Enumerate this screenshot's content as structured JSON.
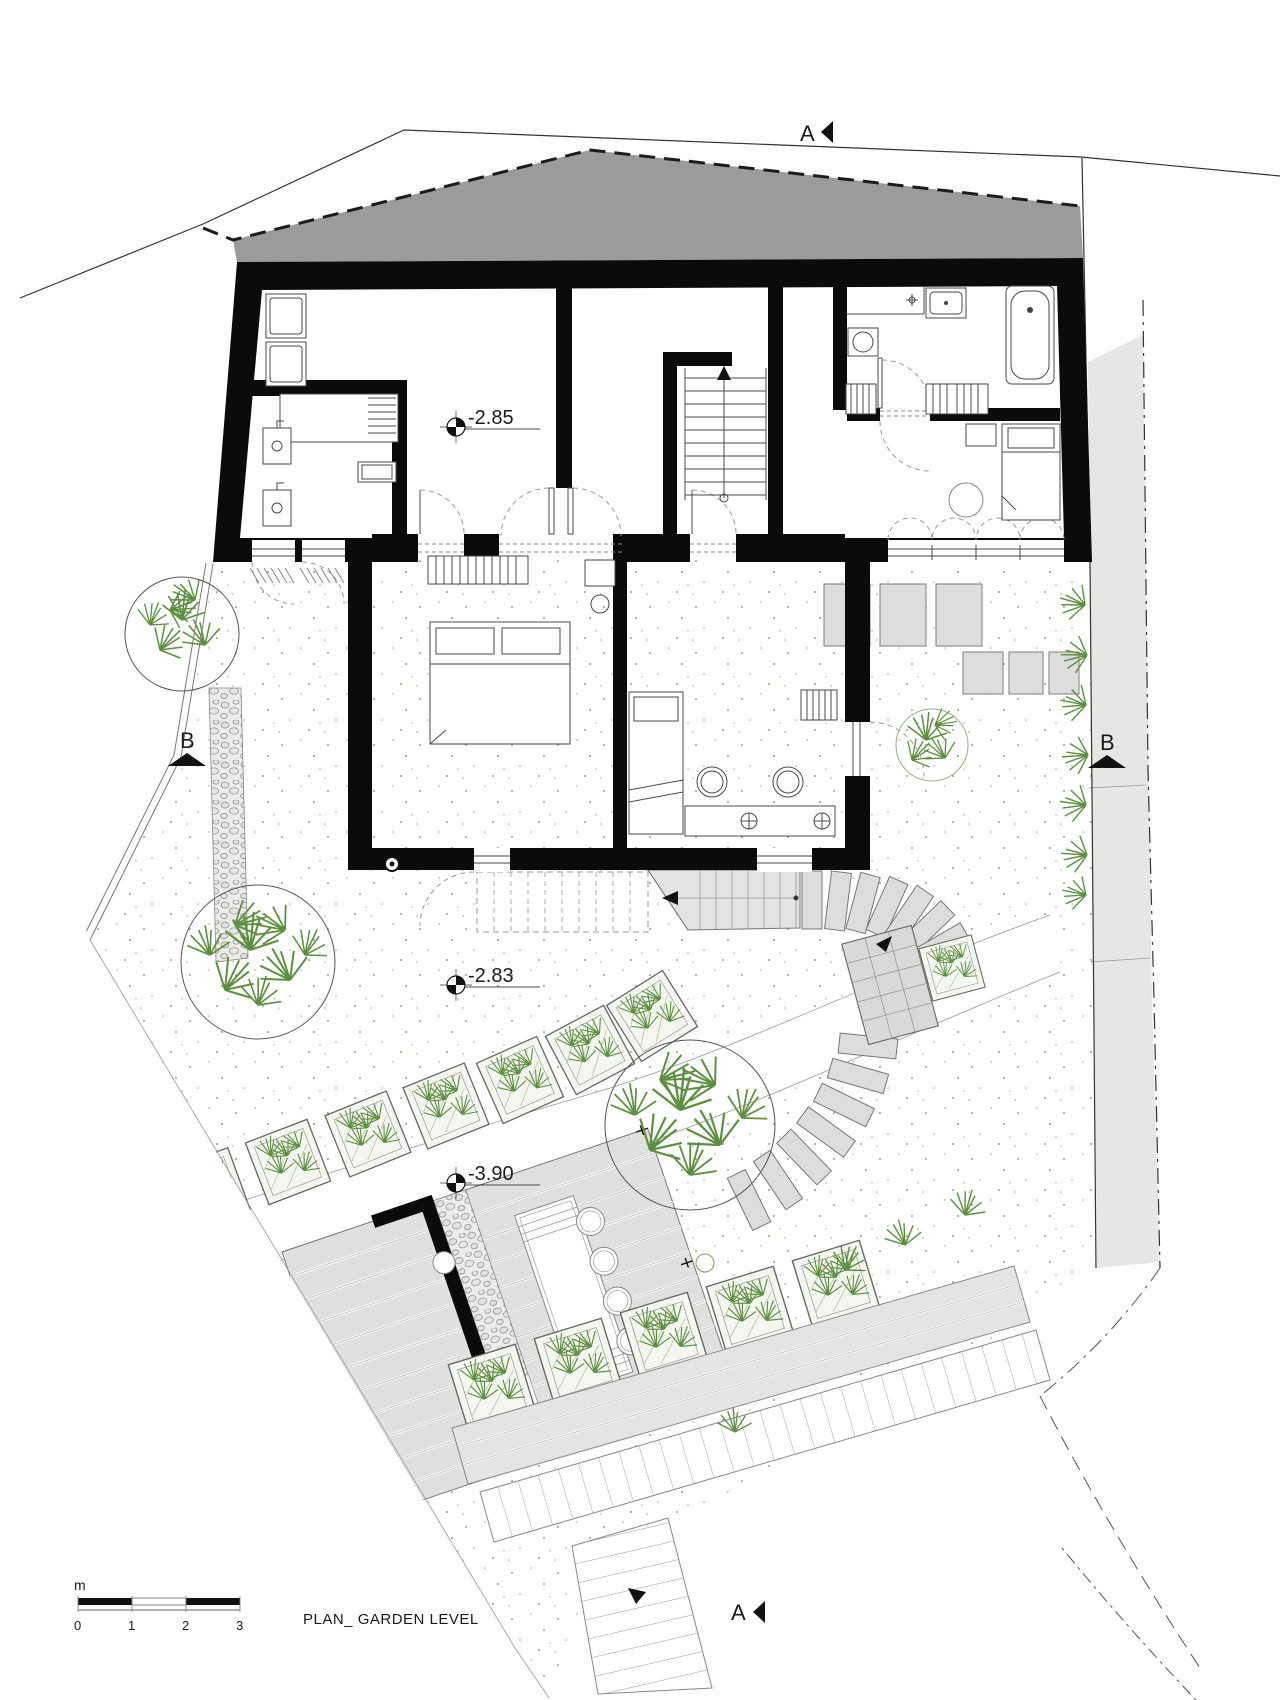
{
  "drawing": {
    "title": "PLAN_ GARDEN LEVEL",
    "scale_bar": {
      "unit": "m",
      "ticks": [
        "0",
        "1",
        "2",
        "3"
      ]
    },
    "level_markers": {
      "hall": "-2.85",
      "terrace": "-2.83",
      "garden": "-3.90"
    },
    "section_markers": {
      "a_top": "A",
      "a_bottom": "A",
      "b_left": "B",
      "b_right": "B"
    },
    "colors": {
      "wall": "#0b0b0b",
      "roof": "#9b9b9b",
      "paving": "#dcdddc",
      "vegetation": "#5d8f42",
      "neighbour_strip": "#e6e6e5"
    }
  }
}
